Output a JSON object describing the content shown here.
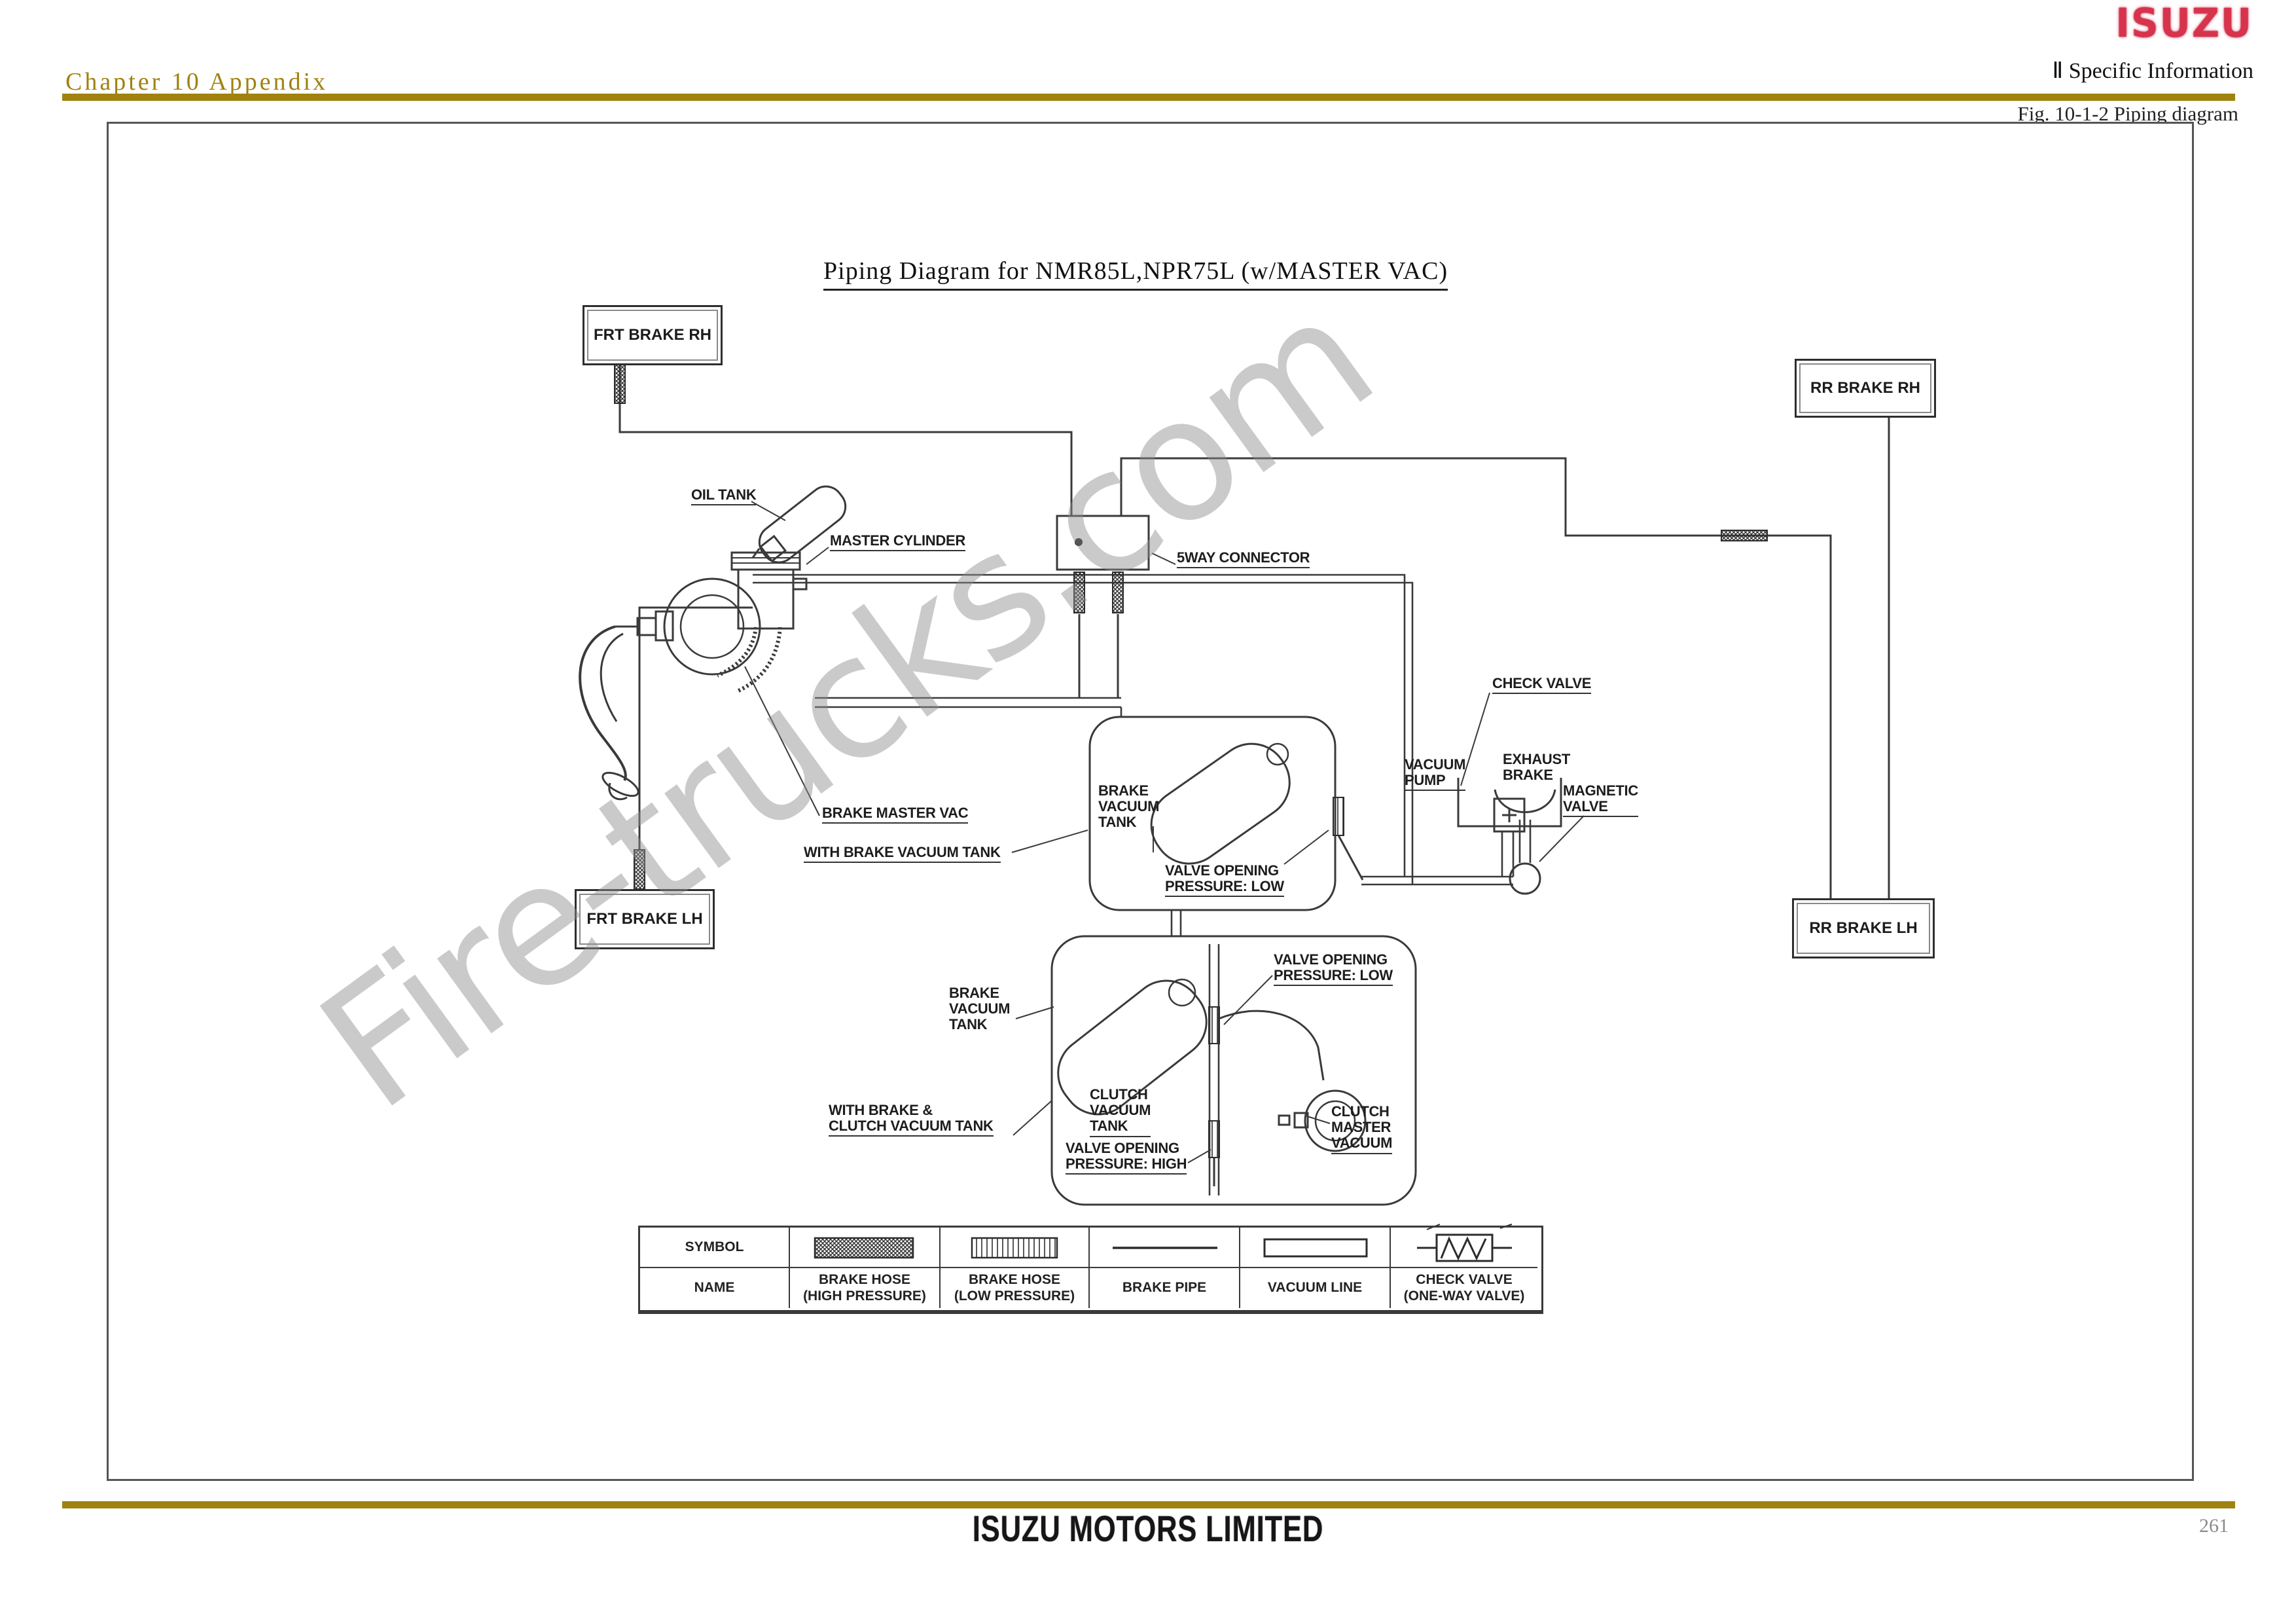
{
  "header": {
    "chapter_title": "Chapter 10 Appendix",
    "brand_logo": "ISUZU",
    "section": "Ⅱ Specific Information",
    "figure_caption": "Fig. 10-1-2 Piping diagram"
  },
  "title": "Piping Diagram for NMR85L,NPR75L (w/MASTER VAC)",
  "watermark": "Fire-trucks.com",
  "footer": {
    "company": "ISUZU MOTORS LIMITED",
    "page_number": "261"
  },
  "colors": {
    "accent_gold": "#a0820e",
    "logo_red": "#d6344c",
    "line": "#3a3a3a",
    "watermark_gray": "#8f8f8f"
  },
  "diagram": {
    "boxes": {
      "frt_brake_rh": "FRT BRAKE RH",
      "rr_brake_rh": "RR BRAKE RH",
      "frt_brake_lh": "FRT BRAKE LH",
      "rr_brake_lh": "RR BRAKE LH"
    },
    "labels": {
      "oil_tank": "OIL TANK",
      "master_cylinder": "MASTER CYLINDER",
      "five_way_connector": "5WAY CONNECTOR",
      "check_valve": "CHECK VALVE",
      "vacuum_pump": "VACUUM\nPUMP",
      "exhaust_brake": "EXHAUST\nBRAKE",
      "magnetic_valve": "MAGNETIC\nVALVE",
      "brake_master_vac": "BRAKE MASTER VAC",
      "with_brake_vacuum_tank": "WITH BRAKE VACUUM TANK",
      "brake_vacuum_tank_1": "BRAKE\nVACUUM\nTANK",
      "valve_opening_low_1": "VALVE OPENING\nPRESSURE: LOW",
      "brake_vacuum_tank_2": "BRAKE\nVACUUM\nTANK",
      "valve_opening_low_2": "VALVE OPENING\nPRESSURE: LOW",
      "clutch_vacuum_tank": "CLUTCH\nVACUUM\nTANK",
      "with_brake_clutch_vacuum_tank": "WITH BRAKE &\nCLUTCH VACUUM TANK",
      "valve_opening_high": "VALVE OPENING\nPRESSURE: HIGH",
      "clutch_master_vacuum": "CLUTCH\nMASTER\nVACUUM"
    }
  },
  "legend": {
    "row_headers": [
      "SYMBOL",
      "NAME"
    ],
    "items": [
      {
        "symbol": "brake-hose-high",
        "name": "BRAKE HOSE\n(HIGH PRESSURE)"
      },
      {
        "symbol": "brake-hose-low",
        "name": "BRAKE HOSE\n(LOW PRESSURE)"
      },
      {
        "symbol": "brake-pipe",
        "name": "BRAKE PIPE"
      },
      {
        "symbol": "vacuum-line",
        "name": "VACUUM LINE"
      },
      {
        "symbol": "check-valve",
        "name": "CHECK VALVE\n(ONE-WAY VALVE)"
      }
    ]
  }
}
